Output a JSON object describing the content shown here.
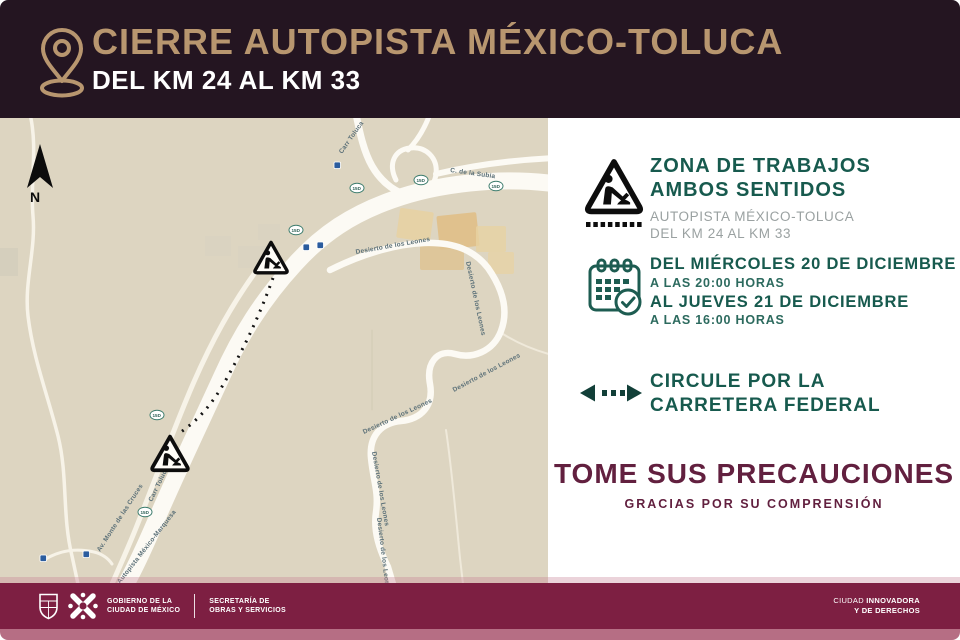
{
  "header": {
    "title": "CIERRE AUTOPISTA MÉXICO-TOLUCA",
    "subtitle": "DEL KM 24 AL KM 33"
  },
  "map": {
    "north_label": "N",
    "shield_label": "15D",
    "labels": [
      {
        "text": "Carr Toluca"
      },
      {
        "text": "C. de la Subia"
      },
      {
        "text": "Desierto de los Leones"
      },
      {
        "text": "Desierto de los Leones"
      },
      {
        "text": "Desierto de los Leones"
      },
      {
        "text": "Desierto de los Leones"
      },
      {
        "text": "Desierto de los Leones"
      },
      {
        "text": "Desierto de los Leones"
      },
      {
        "text": "Carr Toluca"
      },
      {
        "text": "Autopista México-Marquesa"
      },
      {
        "text": "Av. Monte de las Cruces"
      }
    ]
  },
  "info": {
    "works": {
      "line1": "ZONA DE TRABAJOS",
      "line2": "AMBOS SENTIDOS",
      "sub1": "AUTOPISTA MÉXICO-TOLUCA",
      "sub2": "DEL KM 24 AL KM 33"
    },
    "schedule": {
      "line1": "DEL MIÉRCOLES 20 DE DICIEMBRE",
      "line2": "A LAS 20:00 HORAS",
      "line3": "AL JUEVES 21 DE DICIEMBRE",
      "line4": "A LAS 16:00 HORAS"
    },
    "detour": {
      "line1": "CIRCULE POR LA",
      "line2": "CARRETERA FEDERAL"
    },
    "warning": {
      "title": "TOME SUS PRECAUCIONES",
      "subtitle": "GRACIAS POR SU COMPRENSIÓN"
    }
  },
  "footer": {
    "gov": [
      "GOBIERNO DE LA",
      "CIUDAD DE MÉXICO"
    ],
    "dept": [
      "SECRETARÍA DE",
      "OBRAS Y SERVICIOS"
    ],
    "tag_light": "CIUDAD ",
    "tag_bold": "INNOVADORA",
    "tag_line2": "Y DE DERECHOS"
  },
  "icons": {
    "header": "location-pin",
    "works": "roadworks-sign",
    "schedule": "calendar-check",
    "detour": "two-way-dotted-arrow",
    "map_compass": "north-arrow",
    "map_work_signs": "roadworks-sign"
  },
  "colors": {
    "header_bg": "#241521",
    "title_gold": "#b8966f",
    "teal": "#175a4e",
    "subtext_gray": "#9aa1a1",
    "warning_maroon": "#62203f",
    "footer_bg": "#7d1f42",
    "bottom_strip": "#b66e84",
    "map_bg": "#ddd5c1"
  }
}
